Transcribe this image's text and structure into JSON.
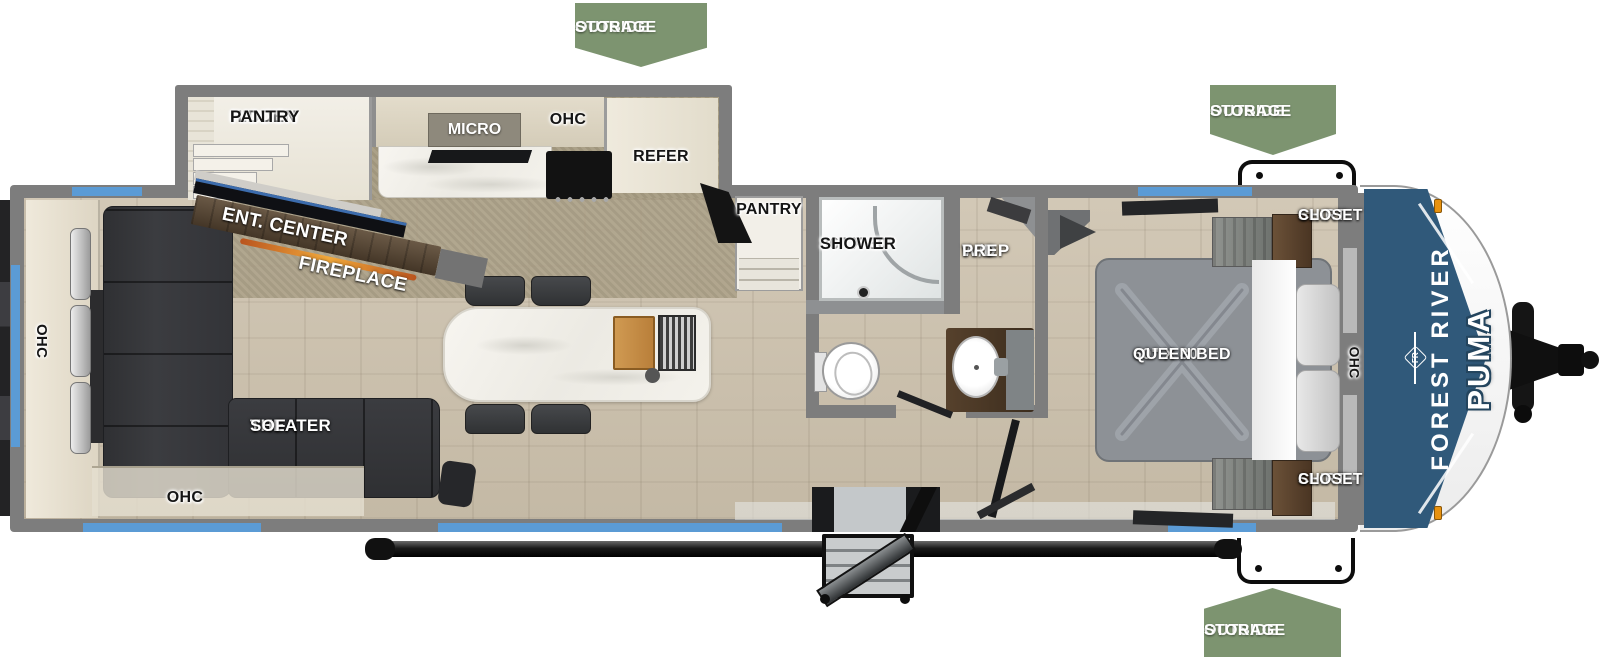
{
  "badges": {
    "top_center": {
      "line1": "OUTSIDE",
      "line2": "STORAGE"
    },
    "top_right": {
      "line1": "OUTSIDE",
      "line2": "STORAGE"
    },
    "bottom_right": {
      "line1": "OUTSIDE",
      "line2": "STORAGE"
    }
  },
  "slide_kitchen": {
    "hidden_pantry": {
      "line1": "HIDDEN",
      "line2": "PANTRY"
    },
    "micro": "MICRO",
    "ohc": "OHC",
    "refer": "REFER"
  },
  "kitchen": {
    "pantry": "PANTRY"
  },
  "living": {
    "ent_center": "ENT. CENTER",
    "fireplace": "FIREPLACE",
    "theater_sofa": {
      "line1": "THEATER",
      "line2": "SOFA"
    },
    "ohc_rear": "OHC",
    "ohc_bottom": "OHC"
  },
  "bathroom": {
    "shower": {
      "line1": "36\" X 30\"",
      "line2": "SHOWER"
    },
    "wd_prep": {
      "line1": "W/D",
      "line2": "PREP"
    }
  },
  "bedroom": {
    "queen_bed": {
      "line1": "60\" X 80\"",
      "line2": "QUEEN BED"
    },
    "shirt_closet_top": {
      "line1": "SHIRT",
      "line2": "CLOSET"
    },
    "shirt_closet_bottom": {
      "line1": "SHIRT",
      "line2": "CLOSET"
    },
    "ohc": "OHC"
  },
  "branding": {
    "make": "FOREST RIVER",
    "model": "PUMA",
    "logo": "FR"
  },
  "colors": {
    "badge_green": "#7d9470",
    "window_blue": "#5b9bd5",
    "cap_blue": "#30597a",
    "wall_gray": "#7d7d7d",
    "accent_orange": "#e8920f",
    "fireplace_orange": "#f2a93b"
  }
}
